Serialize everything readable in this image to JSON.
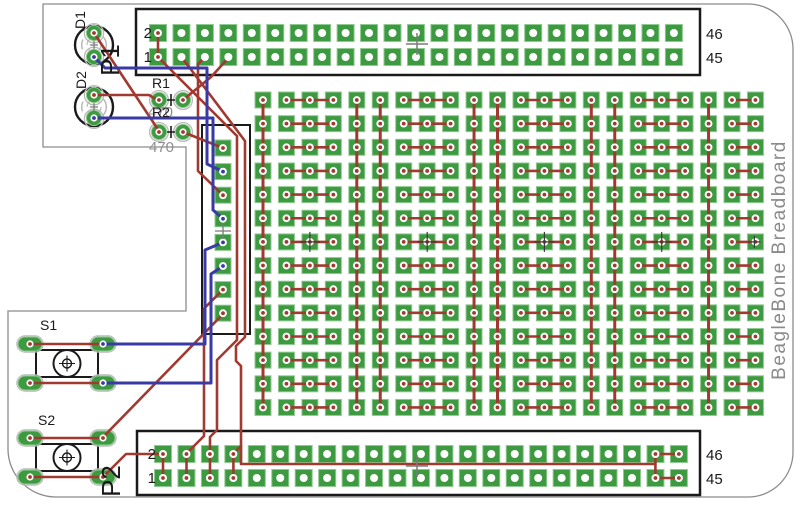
{
  "board": {
    "title": "BeagleBone Breadboard",
    "colors": {
      "background": "#ffffff",
      "pad_green": "#3d9a40",
      "pad_border": "#8fca90",
      "hole_white": "#ffffff",
      "trace_red": "#a03a31",
      "trace_blue": "#3a3aa6",
      "silk_black": "#1a1a1a",
      "silk_gray": "#b9b9b9",
      "board_outline_gray": "#8c8c8c",
      "label_black": "#1a1a1a",
      "label_gray": "#8f8f8f",
      "origin_cross_gray": "#7a7a7a",
      "origin_cross_dark": "#3a3a3a"
    }
  },
  "headers": {
    "p1": {
      "ref": "P1",
      "pins_left": [
        "2",
        "1"
      ],
      "pins_right": [
        "46",
        "45"
      ]
    },
    "p2": {
      "ref": "P2",
      "pins_left": [
        "2",
        "1"
      ],
      "pins_right": [
        "46",
        "45"
      ]
    }
  },
  "components": {
    "d1": {
      "ref": "D1"
    },
    "d2": {
      "ref": "D2"
    },
    "r1": {
      "ref": "R1",
      "value": "470"
    },
    "r2": {
      "ref": "R2",
      "value": "470"
    },
    "s1": {
      "ref": "S1"
    },
    "s2": {
      "ref": "S2"
    }
  },
  "grid": {
    "columns": 22,
    "rows": 14,
    "left_column_pads": 8,
    "header_pin_columns": 23
  }
}
